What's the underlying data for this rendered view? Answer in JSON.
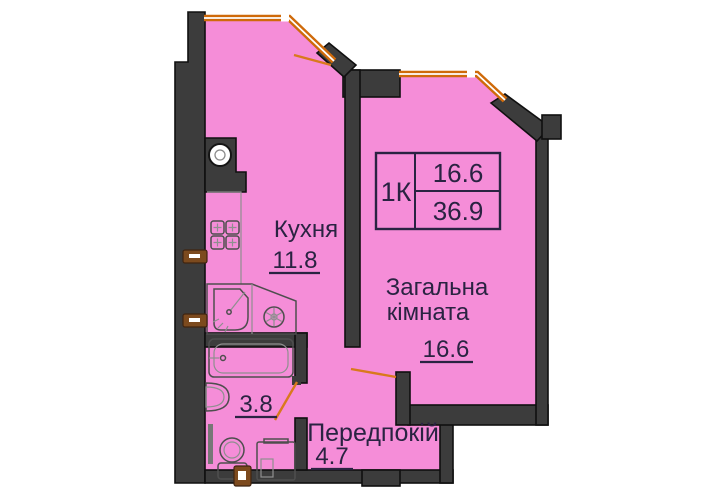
{
  "plan": {
    "info_box": {
      "type_label": "1К",
      "area_top": "16.6",
      "area_bottom": "36.9"
    },
    "rooms": {
      "kitchen": {
        "name": "Кухня",
        "area": "11.8"
      },
      "living_room": {
        "name_line1": "Загальна",
        "name_line2": "кімната",
        "area": "16.6"
      },
      "hallway": {
        "name": "Передпокій",
        "area": "4.7"
      },
      "bathroom": {
        "area": "3.8"
      }
    },
    "colors": {
      "room_fill": "#f58dd8",
      "wall_fill": "#3c3c3c",
      "window_orange": "#cf6a0a",
      "door_swing": "#d9791c",
      "marker_brown": "#7c4a1e",
      "label_text": "#2a2342"
    }
  }
}
